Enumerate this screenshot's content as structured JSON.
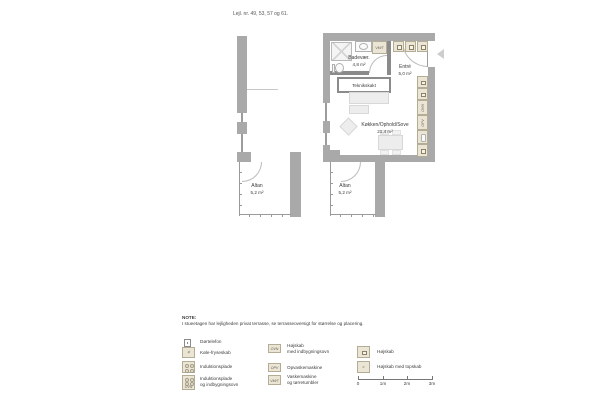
{
  "title": "Lejl. nr. 49, 53, 57 og 61.",
  "plan": {
    "bathroom_name": "Badevær.",
    "bathroom_area": "4,8 m²",
    "entry_name": "Entré",
    "entry_area": "5,0 m²",
    "shaft_name": "Teknikskakt",
    "living_name": "Køkken/Ophold/Sove",
    "living_area": "21,4 m²",
    "balcony_name": "Altan",
    "balcony_area": "5,2 m²"
  },
  "codes": {
    "oven": "OVN",
    "dishwasher": "OPV",
    "washer_dryer": "VM/T"
  },
  "symbols": {
    "fridge_mark": "∗",
    "topskab_mark": "×"
  },
  "note": {
    "heading": "NOTE:",
    "text": "I stueetagen har lejligheden privat terrasse, se terrasseoversigt for størrelse og placering."
  },
  "legend": {
    "items": [
      {
        "icon": "door-phone-icon",
        "label": "Dørtelefon",
        "lines": [
          "Dørtelefon"
        ]
      },
      {
        "icon": "fridge-freezer-icon",
        "label": "Køle-fryseskab",
        "lines": [
          "Køle-fryseskab"
        ]
      },
      {
        "icon": "induction-hob-icon",
        "label": "Induktionsplade",
        "lines": [
          "Induktionsplade"
        ]
      },
      {
        "icon": "induction-hob-oven-icon",
        "label": "Induktionsplade og indbygningsovn",
        "lines": [
          "Induktionsplade",
          "og indbygningsovn"
        ]
      },
      {
        "icon": "tall-cabinet-oven-icon",
        "label": "Højskab med indbygningsovn",
        "lines": [
          "Højskab",
          "med indbygningsovn"
        ]
      },
      {
        "icon": "dishwasher-icon",
        "label": "Opvaskemaskine",
        "lines": [
          "Opvaskemaskine"
        ]
      },
      {
        "icon": "washer-dryer-icon",
        "label": "Vaskemaskine og tørretumbler",
        "lines": [
          "Vaskemaskine",
          "og tørretumbler"
        ]
      },
      {
        "icon": "tall-cabinet-icon",
        "label": "Højskab",
        "lines": [
          "Højskab"
        ]
      },
      {
        "icon": "tall-cabinet-top-icon",
        "label": "Højskab med topskab",
        "lines": [
          "Højskab med topskab"
        ]
      }
    ],
    "scale_labels": [
      "0",
      "1m",
      "2m",
      "3m"
    ]
  },
  "colors": {
    "background": "#ffffff",
    "exterior_wall": "#a9a9a9",
    "interior_wall": "#8b8b8b",
    "cabinet_fill": "#ebe5d6",
    "cabinet_border": "#b5ac95",
    "furniture_fill": "#ededed",
    "text": "#3c3c3c"
  }
}
